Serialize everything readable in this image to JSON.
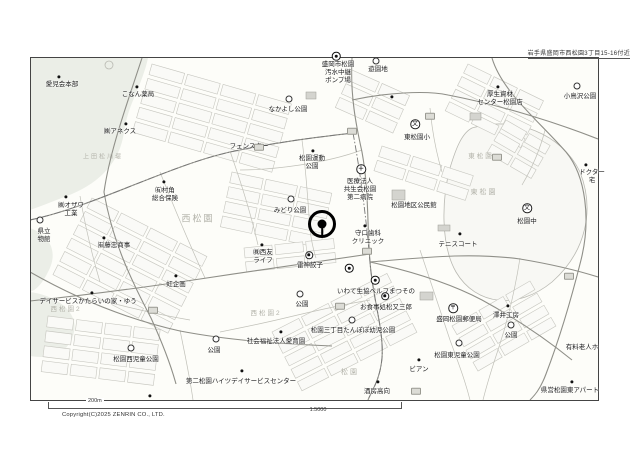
{
  "header": {
    "address_note": "岩手県盛岡市西松園3丁目15-16付近"
  },
  "footer": {
    "scale_bar_label": "200m",
    "scale_ratio": "1:5000",
    "copyright": "Copyright(C)2025 ZENRIN CO., LTD."
  },
  "colors": {
    "paper": "#ffffff",
    "map_background": "#fdfdf9",
    "road_line": "#8f8f88",
    "parcel_line": "#c6c6bf",
    "faint_label": "#b2b2a9",
    "ink": "#1c1c1c"
  },
  "location_pin": {
    "x": 322,
    "y": 224,
    "meaning": "location-pin"
  },
  "symbol_glyphs": {
    "school": "文",
    "post": "〒",
    "hospital": "＋"
  },
  "pois": [
    {
      "text": "愛児会本部",
      "x": 62,
      "y": 81,
      "sym": "dot",
      "sx": 59,
      "sy": 77
    },
    {
      "text": "こなん薬局",
      "x": 138,
      "y": 91,
      "sym": "dot",
      "sx": 137,
      "sy": 87
    },
    {
      "text": "㈱アネクス",
      "x": 120,
      "y": 128,
      "sym": "dot",
      "sx": 126,
      "sy": 124
    },
    {
      "text": "なかよし公園",
      "x": 288,
      "y": 106,
      "sym": "park",
      "sx": 289,
      "sy": 99
    },
    {
      "text": "盛岡市松園\n汚水中継\nポンプ場",
      "x": 338,
      "y": 61,
      "sym": "pump",
      "sx": 336,
      "sy": 56
    },
    {
      "text": "遊園地",
      "x": 378,
      "y": 66,
      "sym": "park",
      "sx": 376,
      "sy": 61
    },
    {
      "text": "厚生資材\nセンター松園店",
      "x": 500,
      "y": 91,
      "sym": "dot",
      "sx": 498,
      "sy": 87
    },
    {
      "text": "小鳥沢公園",
      "x": 580,
      "y": 93,
      "sym": "park",
      "sx": 577,
      "sy": 86
    },
    {
      "text": "東松園小",
      "x": 417,
      "y": 134,
      "sym": "school",
      "sx": 415,
      "sy": 124
    },
    {
      "text": "フェンスター",
      "x": 249,
      "y": 143
    },
    {
      "text": "松園運動\n公園",
      "x": 312,
      "y": 155,
      "sym": "dot",
      "sx": 313,
      "sy": 151
    },
    {
      "text": "ドクター\n宅",
      "x": 592,
      "y": 169,
      "sym": "dot",
      "sx": 586,
      "sy": 165
    },
    {
      "text": "医療法人\n共生会松園\n第二病院",
      "x": 360,
      "y": 178,
      "sym": "hospital",
      "sx": 361,
      "sy": 169
    },
    {
      "text": "松園地区公民館",
      "x": 414,
      "y": 202
    },
    {
      "text": "みどり公園",
      "x": 290,
      "y": 207,
      "sym": "park",
      "sx": 291,
      "sy": 199
    },
    {
      "text": "守口歯科\nクリニック",
      "x": 368,
      "y": 230,
      "sym": "dot",
      "sx": 365,
      "sy": 226
    },
    {
      "text": "㈲村角\n総合保険",
      "x": 165,
      "y": 187,
      "sym": "dot",
      "sx": 164,
      "sy": 182
    },
    {
      "text": "㈱オザワ\n工業",
      "x": 71,
      "y": 202,
      "sym": "dot",
      "sx": 66,
      "sy": 197
    },
    {
      "text": "県立\n物館",
      "x": 44,
      "y": 228,
      "sym": "circle",
      "sx": 40,
      "sy": 220
    },
    {
      "text": "㈲藤忠商事",
      "x": 114,
      "y": 242,
      "sym": "dot",
      "sx": 104,
      "sy": 238
    },
    {
      "text": "虹企画",
      "x": 176,
      "y": 281,
      "sym": "dot",
      "sx": 176,
      "sy": 276
    },
    {
      "text": "㈱西友\nライフ",
      "x": 263,
      "y": 249,
      "sym": "dot",
      "sx": 262,
      "sy": 245
    },
    {
      "text": "雷神餃子",
      "x": 310,
      "y": 262,
      "sym": "shop",
      "sx": 309,
      "sy": 255
    },
    {
      "text": "いわて生協ベルフまつその",
      "x": 376,
      "y": 288,
      "sym": "coop",
      "sx": 375,
      "sy": 280
    },
    {
      "text": "公園",
      "x": 302,
      "y": 301,
      "sym": "park",
      "sx": 300,
      "sy": 294
    },
    {
      "text": "お食事処松又三郎",
      "x": 386,
      "y": 304,
      "sym": "shop",
      "sx": 385,
      "sy": 296
    },
    {
      "text": "松園三丁目たんぽぽ幼児公園",
      "x": 353,
      "y": 327,
      "sym": "park",
      "sx": 352,
      "sy": 320
    },
    {
      "text": "社会福祉法人愛育園",
      "x": 276,
      "y": 338,
      "sym": "dot",
      "sx": 281,
      "sy": 332
    },
    {
      "text": "デイサービスかたらいの家・ゆう",
      "x": 88,
      "y": 298,
      "sym": "dot",
      "sx": 92,
      "sy": 293
    },
    {
      "text": "松園西児童公園",
      "x": 136,
      "y": 356,
      "sym": "park",
      "sx": 131,
      "sy": 348
    },
    {
      "text": "公園",
      "x": 214,
      "y": 347,
      "sym": "park",
      "sx": 216,
      "sy": 339
    },
    {
      "text": "第二松園ハイツデイサービスセンター",
      "x": 241,
      "y": 378,
      "sym": "dot",
      "sx": 242,
      "sy": 371
    },
    {
      "text": "ビアン",
      "x": 419,
      "y": 366,
      "sym": "dot",
      "sx": 419,
      "sy": 360
    },
    {
      "text": "酒房高向",
      "x": 377,
      "y": 388,
      "sym": "dot",
      "sx": 378,
      "sy": 382
    },
    {
      "text": "松園東児童公園",
      "x": 457,
      "y": 352,
      "sym": "park",
      "sx": 459,
      "sy": 343
    },
    {
      "text": "公園",
      "x": 511,
      "y": 332,
      "sym": "park",
      "sx": 511,
      "sy": 325
    },
    {
      "text": "澤井工房",
      "x": 506,
      "y": 312,
      "sym": "dot",
      "sx": 508,
      "sy": 306
    },
    {
      "text": "盛岡松園郵便局",
      "x": 459,
      "y": 316,
      "sym": "post",
      "sx": 453,
      "sy": 308
    },
    {
      "text": "テニスコート",
      "x": 458,
      "y": 241,
      "sym": "dot",
      "sx": 460,
      "sy": 234
    },
    {
      "text": "松園中",
      "x": 527,
      "y": 218,
      "sym": "school",
      "sx": 527,
      "sy": 208
    },
    {
      "text": "有料老人ホ",
      "x": 582,
      "y": 344
    },
    {
      "text": "県営松園東アパート",
      "x": 570,
      "y": 387,
      "sym": "dot",
      "sx": 572,
      "sy": 382
    }
  ],
  "area_labels": [
    {
      "text": "西松園",
      "x": 198,
      "y": 219,
      "size": 9
    },
    {
      "text": "東松園",
      "x": 484,
      "y": 193,
      "size": 7
    },
    {
      "text": "東松園",
      "x": 481,
      "y": 157,
      "size": 6.5
    },
    {
      "text": "西松園2",
      "x": 266,
      "y": 314,
      "size": 6.5
    },
    {
      "text": "西松園2",
      "x": 66,
      "y": 310,
      "size": 6.5
    },
    {
      "text": "松園",
      "x": 350,
      "y": 373,
      "size": 7
    },
    {
      "text": "上田松川堤",
      "x": 103,
      "y": 158,
      "size": 6
    }
  ],
  "extra_symbols": [
    {
      "type": "target",
      "x": 349,
      "y": 268
    },
    {
      "type": "dot",
      "x": 392,
      "y": 97
    },
    {
      "type": "dot",
      "x": 150,
      "y": 396
    }
  ],
  "road_pills": [
    {
      "x": 259,
      "y": 147
    },
    {
      "x": 352,
      "y": 131
    },
    {
      "x": 367,
      "y": 251
    },
    {
      "x": 430,
      "y": 116
    },
    {
      "x": 340,
      "y": 306
    },
    {
      "x": 416,
      "y": 391
    },
    {
      "x": 153,
      "y": 310
    },
    {
      "x": 569,
      "y": 276
    },
    {
      "x": 497,
      "y": 157
    }
  ]
}
